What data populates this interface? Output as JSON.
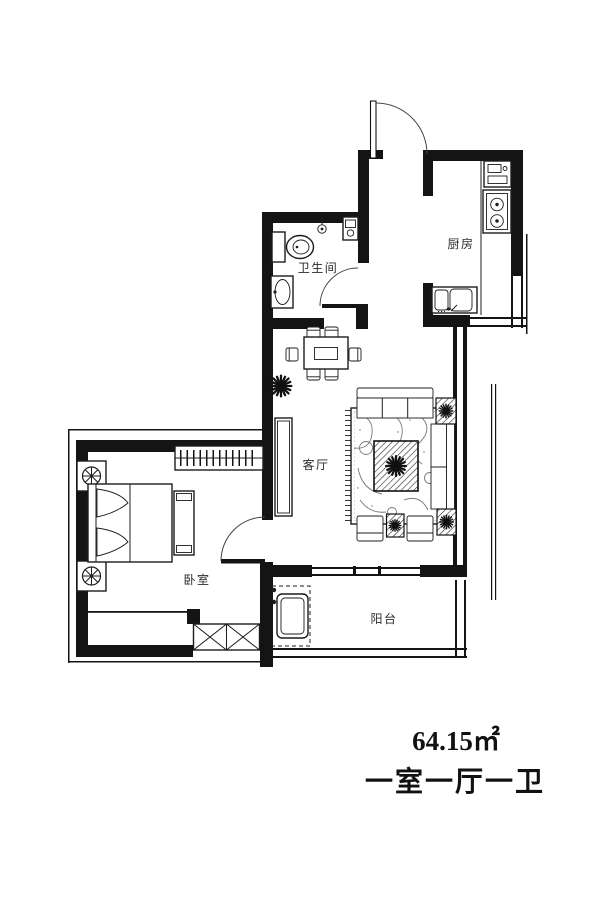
{
  "plan": {
    "area": "64.15㎡",
    "layout": "一室一厅一卫",
    "rooms": {
      "bathroom": "卫生间",
      "kitchen": "厨房",
      "living": "客厅",
      "bedroom": "卧室",
      "balcony": "阳台"
    },
    "icons": [
      "entry-door-icon",
      "bathroom-door-icon",
      "bedroom-door-icon",
      "toilet-icon",
      "shower-icon",
      "water-heater-icon",
      "bathroom-sink-icon",
      "stove-icon",
      "kitchen-appliance-icon",
      "kitchen-sink-icon",
      "dining-table-icon",
      "dining-chair-icon",
      "plant-icon",
      "sofa-icon",
      "coffee-table-icon",
      "rug-icon",
      "side-table-icon",
      "tv-cabinet-icon",
      "bed-icon",
      "nightstand-lamp-icon",
      "wardrobe-icon",
      "bed-bench-icon",
      "bay-cabinet-icon",
      "washing-machine-icon",
      "window-icon"
    ],
    "colors": {
      "wall": "#141414",
      "furniture_line": "#1c1c1c",
      "rug_swirl": "#777777",
      "background": "#ffffff",
      "label_text": "#2b2b2b",
      "caption_text": "#111111"
    }
  }
}
